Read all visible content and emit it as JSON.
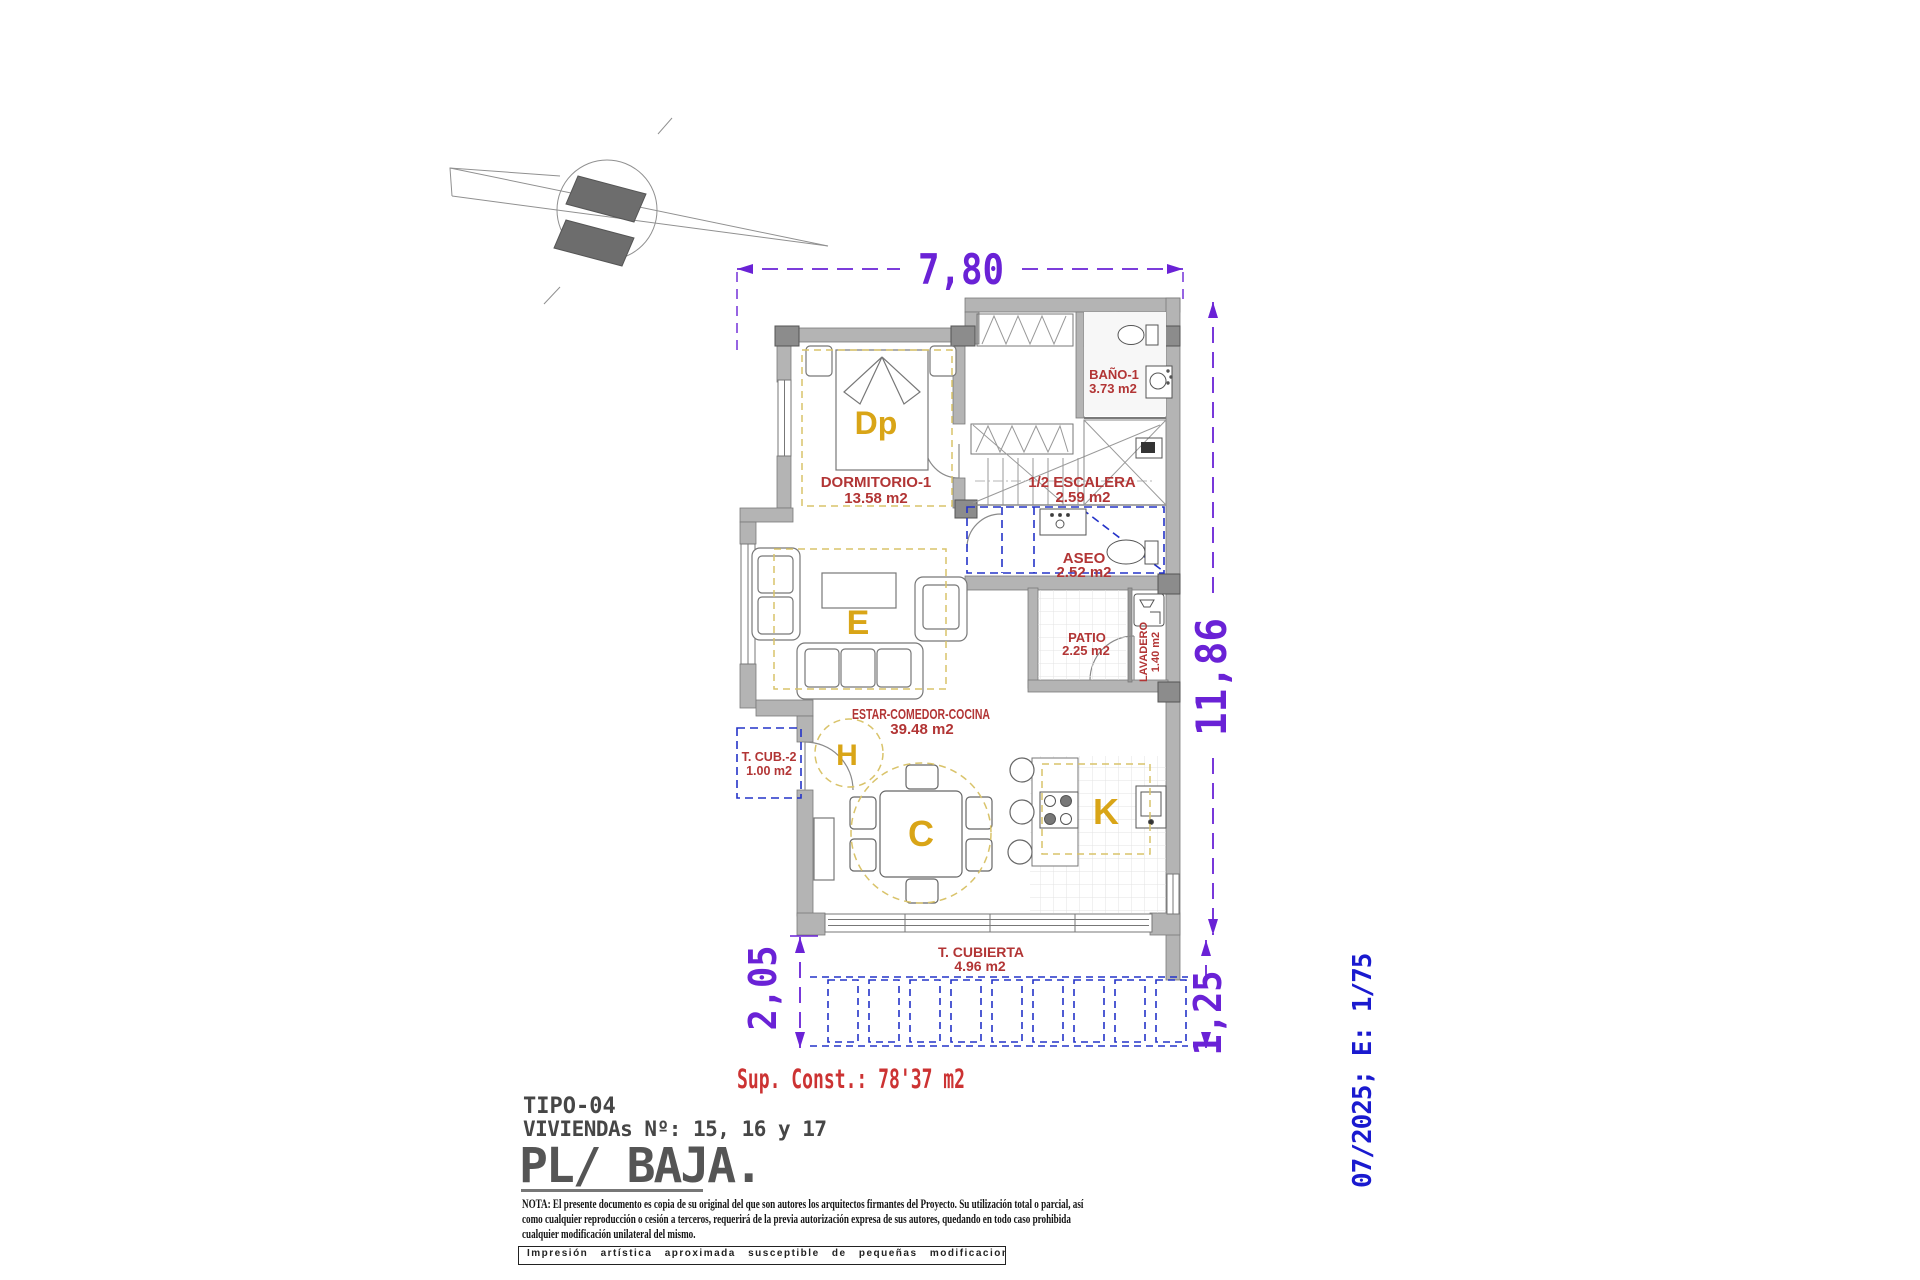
{
  "dimensions": {
    "top": "7,80",
    "right": "11,86",
    "bottom_left": "2,05",
    "bottom_right": "1,25"
  },
  "rooms": {
    "dormitorio1": {
      "name": "DORMITORIO-1",
      "area": "13.58 m2",
      "letter": "Dp"
    },
    "bano1": {
      "name": "BAÑO-1",
      "area": "3.73 m2"
    },
    "escalera": {
      "name": "1/2 ESCALERA",
      "area": "2.59 m2"
    },
    "aseo": {
      "name": "ASEO",
      "area": "2.52 m2"
    },
    "patio": {
      "name": "PATIO",
      "area": "2.25 m2"
    },
    "lavadero": {
      "name": "LAVADERO",
      "area": "1.40 m2"
    },
    "estar_comedor_cocina": {
      "name": "ESTAR-COMEDOR-COCINA",
      "area": "39.48 m2",
      "letter_estar": "E",
      "letter_hall": "H",
      "letter_comedor": "C",
      "letter_cocina": "K"
    },
    "t_cub_2": {
      "name": "T. CUB.-2",
      "area": "1.00 m2"
    },
    "t_cubierta": {
      "name": "T. CUBIERTA",
      "area": "4.96 m2"
    }
  },
  "summary": {
    "sup_const": "Sup. Const.: 78'37 m2"
  },
  "title_block": {
    "tipo": "TIPO-04",
    "viviendas": "VIVIENDAs Nº: 15, 16 y 17",
    "planta": "PL/ BAJA."
  },
  "revision": {
    "date_scale": "07/2025; E: 1/75"
  },
  "notes": {
    "line1": "NOTA: El presente documento es copia de su original del que son autores los arquitectos firmantes del Proyecto. Su utilización total o parcial, así",
    "line2": "como cualquier reproducción o cesión a terceros, requerirá de la previa autorización expresa de sus autores, quedando en todo caso prohibida",
    "line3": "cualquier modificación unilateral del mismo.",
    "impresion": "Impresión artística aproximada susceptible de pequeñas modificaciones."
  },
  "colors": {
    "dimension_purple": "#6a22d6",
    "annotation_red": "#b23535",
    "sup_const_red": "#cc3333",
    "zone_letter_orange": "#d9a517",
    "cad_blue": "#2433c8",
    "revision_blue": "#1a1acf",
    "wall_gray": "#b4b4b4",
    "title_gray": "#4a4a4a",
    "guide_yellow": "#d9c36a"
  }
}
